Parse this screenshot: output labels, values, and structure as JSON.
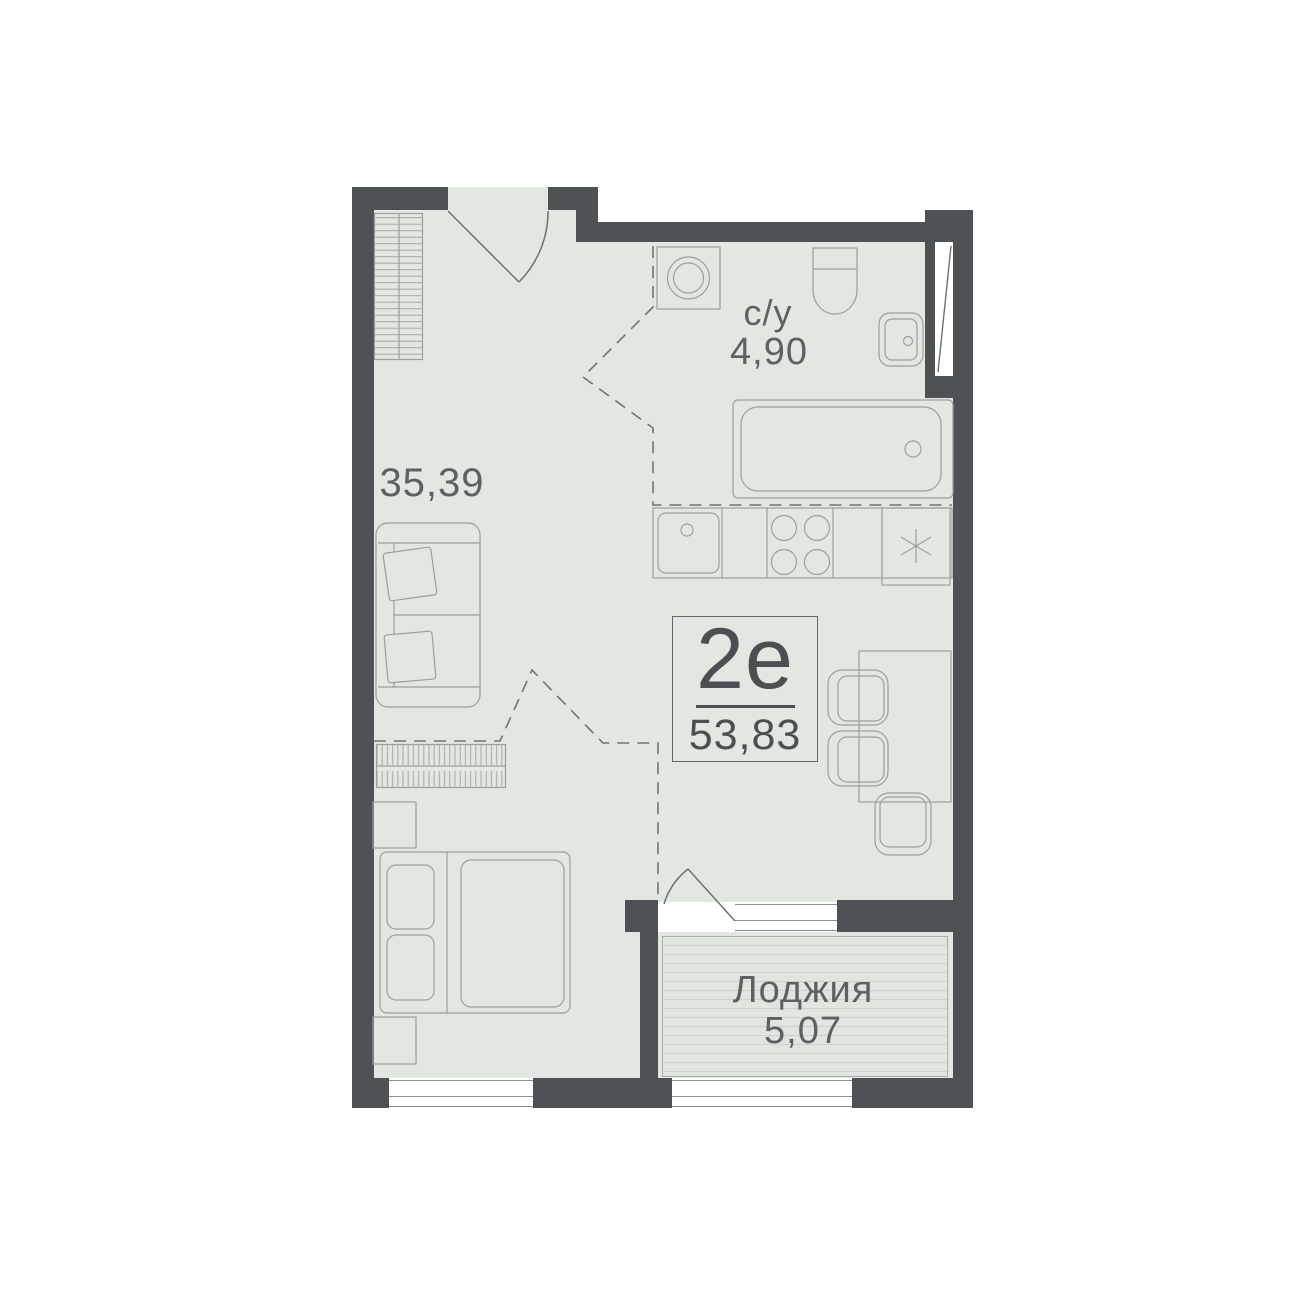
{
  "plan": {
    "unit": {
      "type_label": "2е",
      "total_area": "53,83"
    },
    "rooms": [
      {
        "id": "living-room",
        "area_label": "35,39"
      },
      {
        "id": "bathroom",
        "name": "с/у",
        "area_label": "4,90"
      },
      {
        "id": "loggia",
        "name": "Лоджия",
        "area_label": "5,07"
      }
    ],
    "colors": {
      "wall": "#4f5254",
      "floor": "#e3e7e1",
      "furniture_line": "#9aa09b",
      "dashed_zone_line": "#6f7573",
      "room_label_text": "#5c6164",
      "unit_label_text": "#4b4f52",
      "loggia_stripe": "#cbd2ca"
    }
  }
}
